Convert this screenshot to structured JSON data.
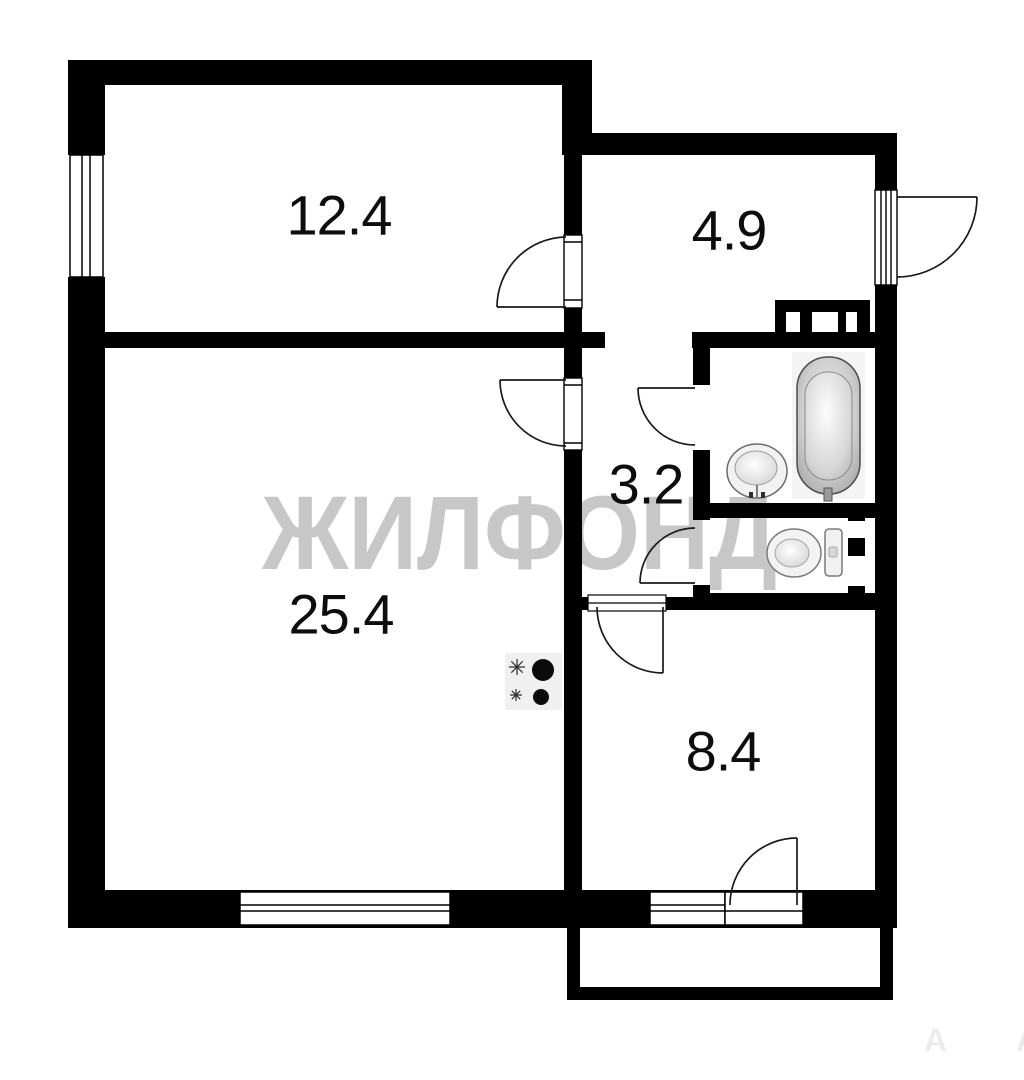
{
  "watermark": {
    "text": "ЖИЛФОНД",
    "color": "#c7c7c7"
  },
  "watermark_faint": {
    "text": "А А",
    "color": "#ececec"
  },
  "rooms": [
    {
      "id": "room-top-left",
      "area": "12.4"
    },
    {
      "id": "hallway",
      "area": "4.9"
    },
    {
      "id": "corridor",
      "area": "3.2"
    },
    {
      "id": "living-room",
      "area": "25.4"
    },
    {
      "id": "kitchen",
      "area": "8.4"
    }
  ],
  "fixtures": [
    {
      "icon": "bathtub-icon"
    },
    {
      "icon": "sink-icon"
    },
    {
      "icon": "toilet-icon"
    },
    {
      "icon": "stove-burners-icon"
    }
  ],
  "colors": {
    "wall": "#000000",
    "background": "#ffffff",
    "fixture_fill": "#f2f2f2",
    "watermark": "#c7c7c7"
  }
}
